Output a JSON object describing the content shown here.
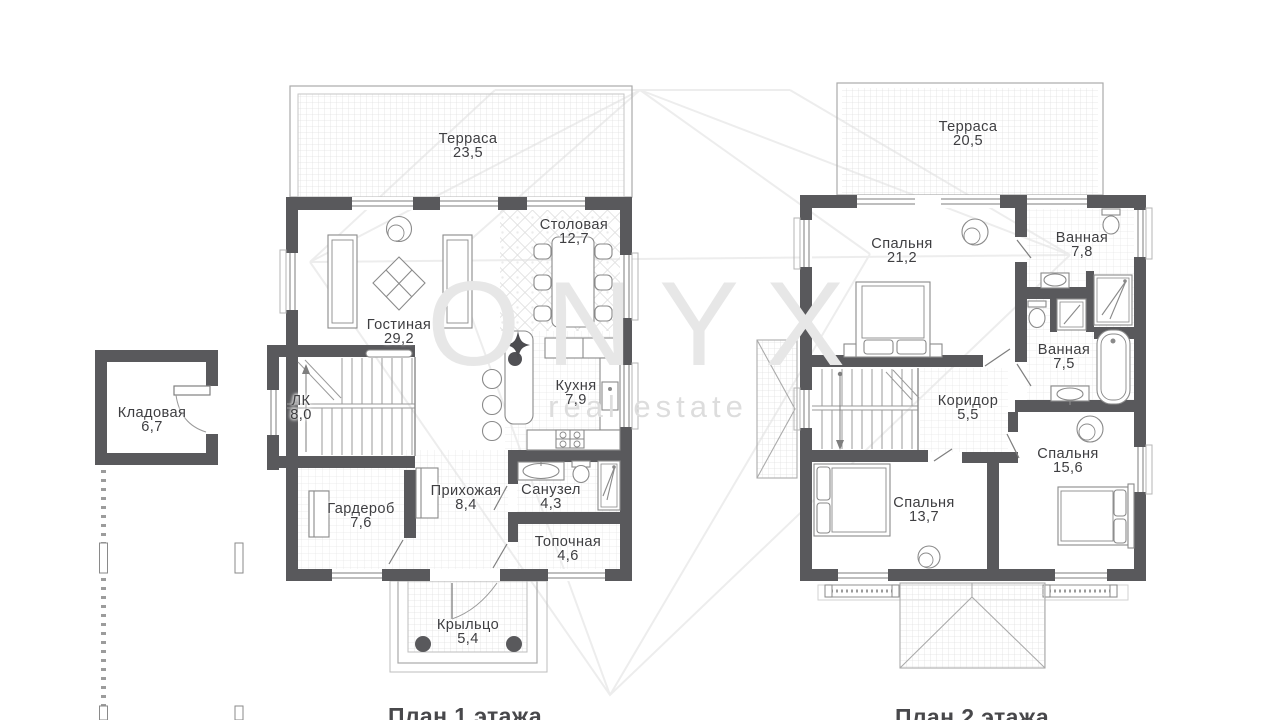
{
  "watermark": {
    "brand": "ONYX",
    "tagline": "real estate"
  },
  "floors": [
    {
      "caption": "План 1 этажа",
      "caption_x": 465,
      "caption_y": 703,
      "rooms": [
        {
          "name": "Терраса",
          "area": "23,5",
          "x": 468,
          "y": 133
        },
        {
          "name": "Столовая",
          "area": "12,7",
          "x": 574,
          "y": 219
        },
        {
          "name": "Гостиная",
          "area": "29,2",
          "x": 399,
          "y": 319
        },
        {
          "name": "Кладовая",
          "area": "6,7",
          "x": 152,
          "y": 407
        },
        {
          "name": "ЛК",
          "area": "8,0",
          "x": 301,
          "y": 395
        },
        {
          "name": "Кухня",
          "area": "7,9",
          "x": 576,
          "y": 380
        },
        {
          "name": "Прихожая",
          "area": "8,4",
          "x": 466,
          "y": 485
        },
        {
          "name": "Санузел",
          "area": "4,3",
          "x": 551,
          "y": 484
        },
        {
          "name": "Гардероб",
          "area": "7,6",
          "x": 361,
          "y": 503
        },
        {
          "name": "Топочная",
          "area": "4,6",
          "x": 568,
          "y": 536
        },
        {
          "name": "Крыльцо",
          "area": "5,4",
          "x": 468,
          "y": 619
        }
      ]
    },
    {
      "caption": "План 2 этажа",
      "caption_x": 972,
      "caption_y": 704,
      "rooms": [
        {
          "name": "Терраса",
          "area": "20,5",
          "x": 968,
          "y": 121
        },
        {
          "name": "Спальня",
          "area": "21,2",
          "x": 902,
          "y": 238
        },
        {
          "name": "Ванная",
          "area": "7,8",
          "x": 1082,
          "y": 232
        },
        {
          "name": "Ванная",
          "area": "7,5",
          "x": 1064,
          "y": 344
        },
        {
          "name": "Коридор",
          "area": "5,5",
          "x": 968,
          "y": 395
        },
        {
          "name": "Спальня",
          "area": "15,6",
          "x": 1068,
          "y": 448
        },
        {
          "name": "Спальня",
          "area": "13,7",
          "x": 924,
          "y": 497
        }
      ]
    }
  ]
}
